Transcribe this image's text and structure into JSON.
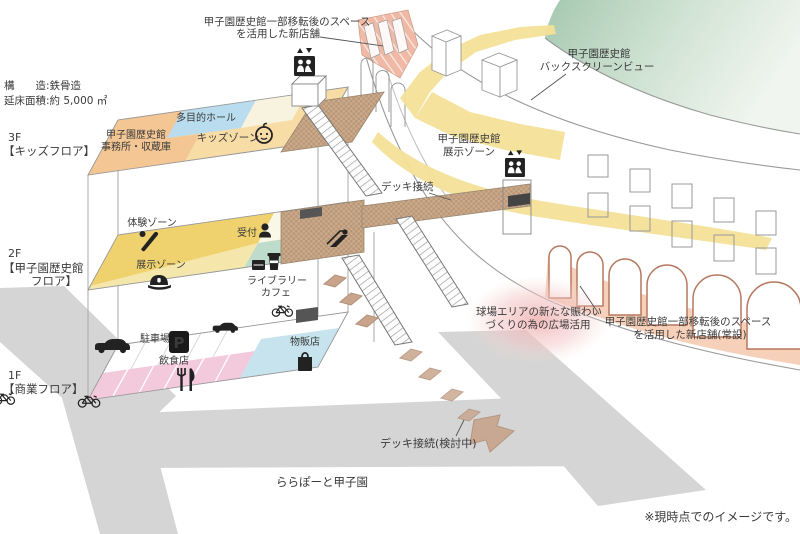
{
  "title_block": {
    "structure": "構　　造:鉄骨造",
    "floor_area": "延床面積:約 5,000 ㎡"
  },
  "floors": {
    "f3": {
      "tag": "3F",
      "label": "【キッズフロア】",
      "zones": {
        "office1": "甲子園歴史館",
        "office2": "事務所・収蔵庫",
        "multipurpose": "多目的ホール",
        "kids": "キッズゾーン"
      }
    },
    "f2": {
      "tag": "2F",
      "label1": "【甲子園歴史館",
      "label2": "フロア】",
      "zones": {
        "taiken": "体験ゾーン",
        "uketsuke": "受付",
        "tenji": "展示ゾーン",
        "library1": "ライブラリー",
        "library2": "カフェ"
      }
    },
    "f1": {
      "tag": "1F",
      "label": "【商業フロア】",
      "zones": {
        "parking": "駐車場",
        "p": "P",
        "restaurant": "飲食店",
        "shop": "物販店"
      }
    }
  },
  "stadium": {
    "backscreen1": "甲子園歴史館",
    "backscreen2": "バックスクリーンビュー",
    "tenji1": "甲子園歴史館",
    "tenji2": "展示ゾーン",
    "newshop_top1": "甲子園歴史館一部移転後のスペース",
    "newshop_top2": "を活用した新店舗",
    "newshop_right1": "甲子園歴史館一部移転後のスペース",
    "newshop_right2": "を活用した新店舗(常設)",
    "plaza1": "球場エリアの新たな賑わい",
    "plaza2": "づくりの為の広場活用"
  },
  "deck": {
    "connect": "デッキ接続",
    "connect_planned": "デッキ接続(検討中)"
  },
  "footer": {
    "lalaport": "ららぽーと甲子園",
    "disclaimer": "※現時点でのイメージです。"
  },
  "colors": {
    "road": "#d5d5d5",
    "deck": "#cbaa8c",
    "field_green": "#a5c8af",
    "stadium_zone_yellow": "#f3e098",
    "arcade_pink": "#f6cdb5",
    "newshop_hatch_pink": "#f0b9a5",
    "plaza_pink": "#efb0b0",
    "kids_zone": "#f8dca6",
    "office_orange": "#f4c693",
    "multipurpose_blue": "#b9dcee",
    "taiken_yellow": "#efd26e",
    "tenji_pale_yellow": "#f5e7ac",
    "library_green": "#bedccc",
    "restaurant_pink": "#f3c9dc",
    "shop_blue": "#c6e3ee"
  }
}
